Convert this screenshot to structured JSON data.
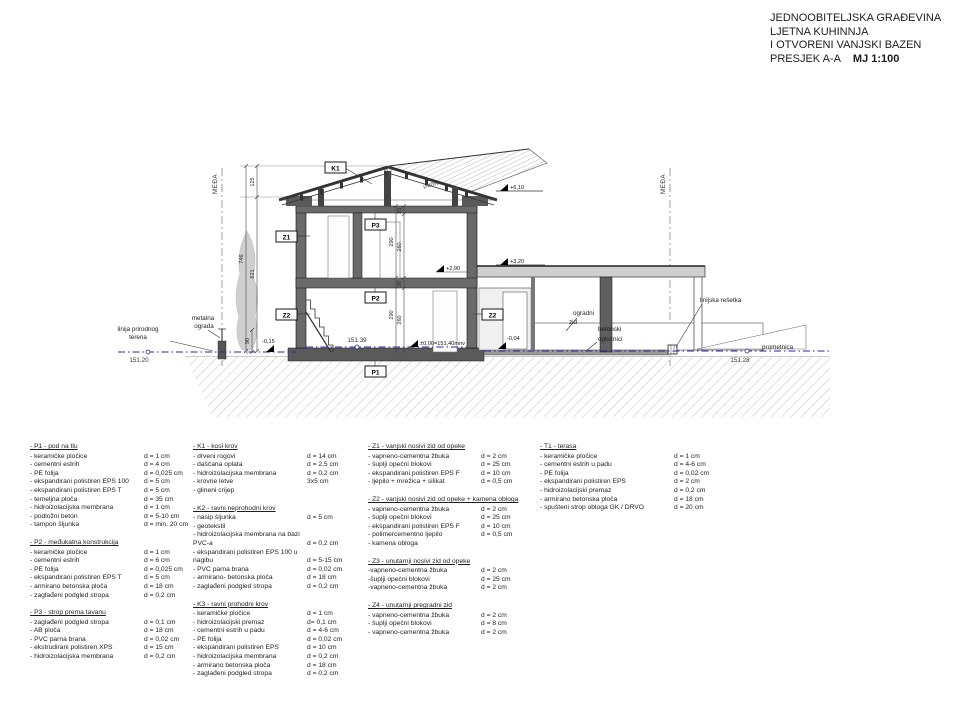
{
  "title_block": {
    "line1": "JEDNOOBITELJSKA GRAĐEVINA",
    "line2": "LJETNA KUHINNJA",
    "line3": "I OTVORENI VANJSKI BAZEN",
    "line4": "PRESJEK  A-A",
    "scale": "MJ 1:100"
  },
  "drawing": {
    "meda_left": "MEĐA",
    "meda_right": "MEĐA",
    "tag_k1": "K1",
    "tag_z1": "Z1",
    "tag_z2_left": "Z2",
    "tag_z2_right": "Z2",
    "tag_p1": "P1",
    "tag_p2": "P2",
    "tag_p3": "P3",
    "elev_ridge": "+6,10",
    "elev_flat_roof": "+3,20",
    "elev_floor2": "+2,90",
    "elev_zero": "±0,00=151,40mnv",
    "elev_minus_left": "-0,15",
    "elev_minus_right": "-0,04",
    "level_terrain_left": "151.20",
    "level_floor": "151.39",
    "level_road": "151.28",
    "ann_terrain_line1": "linija prirodnog",
    "ann_terrain_line2": "terena",
    "ann_fence_line1": "metalna",
    "ann_fence_line2": "ograda",
    "ann_wall_line1": "ogradni",
    "ann_wall_line2": "zid",
    "ann_pavers_line1": "betonski",
    "ann_pavers_line2": "opločnici",
    "ann_grate": "linijska rešetka",
    "ann_road": "prometnica",
    "dim_125": "125",
    "dim_746": "746",
    "dim_621": "621",
    "dim_90": "90",
    "dim_46": "46",
    "dim_33": "33",
    "dim_290_up": "290",
    "dim_260_up": "260",
    "dim_30": "30",
    "dim_290_dn": "290",
    "dim_260_dn": "260",
    "roof_slope": "i=40%"
  },
  "legend": {
    "columns": [
      [
        {
          "title": "- P1 -  pod na tlu",
          "items": [
            {
              "t": "- keramičke pločice",
              "v": "d = 1 cm"
            },
            {
              "t": "- cementni estrih",
              "v": "d = 4 cm"
            },
            {
              "t": "- PE folija",
              "v": "d = 0,025 cm"
            },
            {
              "t": "- ekspandirani polistiren EPS 100",
              "v": "d = 5 cm"
            },
            {
              "t": "- ekspandirani polistiren EPS T",
              "v": "d = 5 cm"
            },
            {
              "t": "- temeljna ploča",
              "v": "d = 35 cm"
            },
            {
              "t": "- hidroizolacijska membrana",
              "v": "d = 1 cm"
            },
            {
              "t": "- podložni beton",
              "v": "d = 5-10 cm"
            },
            {
              "t": "- tampon šljunka",
              "v": "d = min. 20 cm"
            }
          ]
        },
        {
          "title": "- P2 - međukatna konstrukcija",
          "items": [
            {
              "t": "- keramičke pločice",
              "v": "d = 1 cm"
            },
            {
              "t": "- cementni estrih",
              "v": "d = 6 cm"
            },
            {
              "t": "- PE folija",
              "v": "d = 0,025 cm"
            },
            {
              "t": "- ekspandirani polistiren EPS T",
              "v": "d = 5 cm"
            },
            {
              "t": "- armirano betonska ploča",
              "v": "d = 18 cm"
            },
            {
              "t": "- zaglađeni podgled stropa",
              "v": "d = 0,2 cm"
            }
          ]
        },
        {
          "title": "- P3 -  strop prema tavanu",
          "items": [
            {
              "t": "- zaglađeni podgled stropa",
              "v": "d = 0,1 cm"
            },
            {
              "t": "- AB ploča",
              "v": "d = 18 cm"
            },
            {
              "t": "- PVC parna brana",
              "v": "d = 0,02 cm"
            },
            {
              "t": "- ekstrudirani polistiren XPS",
              "v": "d = 15 cm"
            },
            {
              "t": "- hidroizolacijska membrana",
              "v": "d = 0,2 cm"
            }
          ]
        }
      ],
      [
        {
          "title": "- K1 -  kosi krov",
          "items": [
            {
              "t": "- drveni rogovi",
              "v": "d = 14 cm"
            },
            {
              "t": "- daščana oplata",
              "v": "d = 2.5 cm"
            },
            {
              "t": "- hidroizolacijska membrana",
              "v": "d = 0,2 cm"
            },
            {
              "t": "- krovne letve",
              "v": "3x5 cm"
            },
            {
              "t": "- glineni crijep",
              "v": ""
            }
          ]
        },
        {
          "title": "- K2 - ravni neprohodni krov",
          "items": [
            {
              "t": "- nasip šljunka",
              "v": "d = 5 cm"
            },
            {
              "t": "- geotekstil",
              "v": ""
            },
            {
              "t": "- hidroizolacijska membrana na bazi PVC-a",
              "v": "d = 0,2 cm"
            },
            {
              "t": "- ekspandirani polistiren EPS 100 u nagibu",
              "v": "d = 5-15 cm"
            },
            {
              "t": "- PVC parna brana",
              "v": "d = 0,02 cm"
            },
            {
              "t": "- armirano- betonska ploča",
              "v": "d = 18 cm"
            },
            {
              "t": "- zaglađeni podgled stropa",
              "v": "d = 0,2 cm"
            }
          ]
        },
        {
          "title": "- K3 - ravni prohodni krov",
          "items": [
            {
              "t": "- keramičke pločice",
              "v": "d = 1 cm"
            },
            {
              "t": "- hidroizolacijski premaz",
              "v": "d= 0,1 cm"
            },
            {
              "t": "- cementni estrih u padu",
              "v": "d = 4-6 cm"
            },
            {
              "t": "- PE folija",
              "v": "d = 0,02 cm"
            },
            {
              "t": "- ekspandirani polistiren EPS",
              "v": "d = 10 cm"
            },
            {
              "t": "- hidroizolacijska membrana",
              "v": "d = 0,2 cm"
            },
            {
              "t": "- armirano betonska ploča",
              "v": "d = 18 cm"
            },
            {
              "t": "- zaglađeni podgled stropa",
              "v": "d = 0,2 cm"
            }
          ]
        }
      ],
      [
        {
          "title": "- Z1 - vanjski nosivi zid od opeke",
          "items": [
            {
              "t": "- vapneno-cementna žbuka",
              "v": "d = 2 cm"
            },
            {
              "t": "- šuplji opečni blokovi",
              "v": "d = 25 cm"
            },
            {
              "t": "- ekspandirani polistiren EPS F",
              "v": "d = 10 cm"
            },
            {
              "t": "- ljepilo + mrežica + silikat",
              "v": "d = 0,5 cm"
            }
          ]
        },
        {
          "title": "- Z2 - vanjski nosivi zid od opeke + kamena obloga",
          "items": [
            {
              "t": "- vapneno-cementna žbuka",
              "v": "d = 2 cm"
            },
            {
              "t": "- šuplji opečni blokovi",
              "v": "d = 25 cm"
            },
            {
              "t": "- ekspandirani polistiren EPS F",
              "v": "d = 10 cm"
            },
            {
              "t": "- polimercementno ljepilo",
              "v": "d = 0,5 cm"
            },
            {
              "t": "- kamena obloga",
              "v": ""
            }
          ]
        },
        {
          "title": "- Z3 - unutarnji nosivi zid od opeke",
          "items": [
            {
              "t": "-vapneno-cementna žbuka",
              "v": "d = 2 cm"
            },
            {
              "t": "-šuplji opečni blokovi",
              "v": "d = 25 cm"
            },
            {
              "t": "-vapneno-cementna žbuka",
              "v": "d = 2 cm"
            }
          ]
        },
        {
          "title": "- Z4 - unutarnji pregradni zid",
          "items": [
            {
              "t": "- vapneno-cementna žbuka",
              "v": "d = 2 cm"
            },
            {
              "t": "- šuplji opečni blokovi",
              "v": "d = 8 cm"
            },
            {
              "t": "- vapneno-cementna žbuka",
              "v": "d = 2 cm"
            }
          ]
        }
      ],
      [
        {
          "title": "- T1 - terasa",
          "items": [
            {
              "t": "- keramičke pločice",
              "v": "d = 1 cm"
            },
            {
              "t": "- cementni estrih u padu",
              "v": "d = 4-6 cm"
            },
            {
              "t": "- PE folija",
              "v": "d = 0,02 cm"
            },
            {
              "t": "- ekspandirani polistiren EPS",
              "v": "d = 2 cm"
            },
            {
              "t": "- hidroizolacijski premaz",
              "v": "d = 0,2 cm"
            },
            {
              "t": "- armirano betonska ploča",
              "v": "d = 18 cm"
            },
            {
              "t": "- spušteni strop obloga GK / DRVO",
              "v": "d = 20 cm"
            }
          ]
        }
      ]
    ]
  }
}
